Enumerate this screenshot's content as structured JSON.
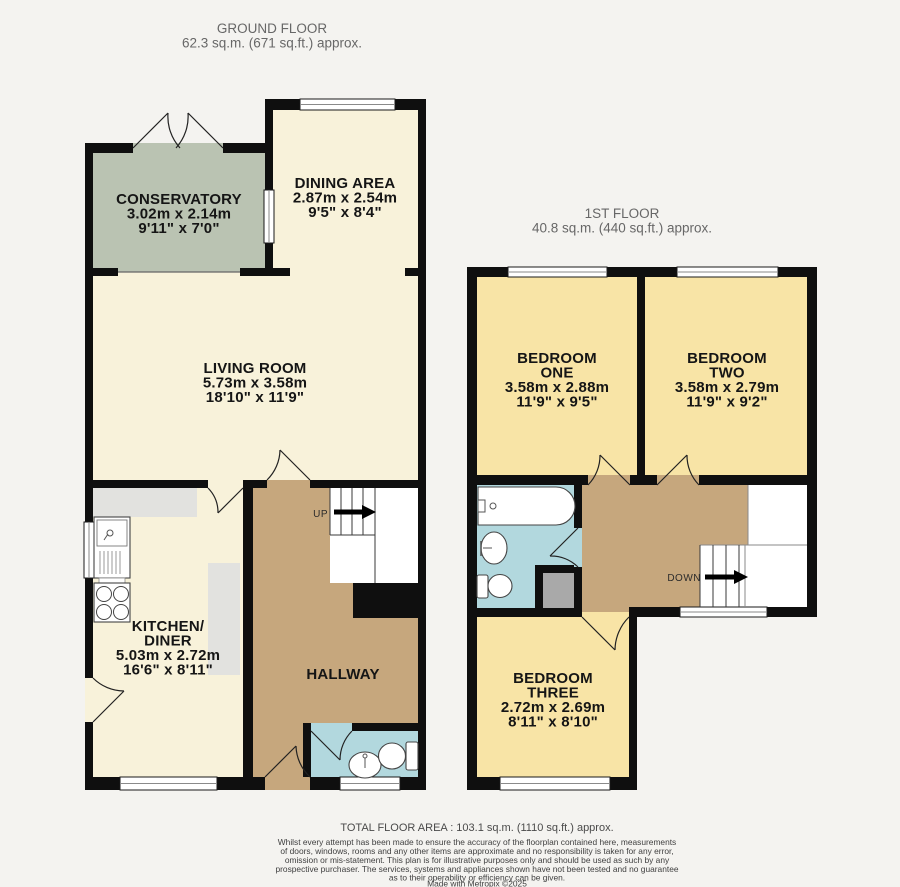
{
  "floors": {
    "ground": {
      "title": "GROUND FLOOR",
      "area": "62.3 sq.m. (671 sq.ft.) approx."
    },
    "first": {
      "title": "1ST FLOOR",
      "area": "40.8 sq.m. (440 sq.ft.) approx."
    }
  },
  "rooms": {
    "conservatory": {
      "name": "CONSERVATORY",
      "metric": "3.02m x 2.14m",
      "imperial": "9'11\" x 7'0\""
    },
    "dining": {
      "name": "DINING AREA",
      "metric": "2.87m x 2.54m",
      "imperial": "9'5\" x 8'4\""
    },
    "living": {
      "name": "LIVING ROOM",
      "metric": "5.73m x 3.58m",
      "imperial": "18'10\" x 11'9\""
    },
    "kitchen": {
      "name_line1": "KITCHEN/",
      "name_line2": "DINER",
      "metric": "5.03m x 2.72m",
      "imperial": "16'6\" x 8'11\""
    },
    "hallway": {
      "name": "HALLWAY"
    },
    "bedroom1": {
      "name_line1": "BEDROOM",
      "name_line2": "ONE",
      "metric": "3.58m x 2.88m",
      "imperial": "11'9\" x 9'5\""
    },
    "bedroom2": {
      "name_line1": "BEDROOM",
      "name_line2": "TWO",
      "metric": "3.58m x 2.79m",
      "imperial": "11'9\" x 9'2\""
    },
    "bedroom3": {
      "name_line1": "BEDROOM",
      "name_line2": "THREE",
      "metric": "2.72m x 2.69m",
      "imperial": "8'11\" x 8'10\""
    }
  },
  "stairs": {
    "up": "UP",
    "down": "DOWN"
  },
  "footer": {
    "total": "TOTAL FLOOR AREA : 103.1 sq.m. (1110 sq.ft.) approx.",
    "disclaimer": [
      "Whilst every attempt has been made to ensure the accuracy of the floorplan contained here, measurements",
      "of doors, windows, rooms and any other items are approximate and no responsibility is taken for any error,",
      "omission or mis-statement. This plan is for illustrative purposes only and should be used as such by any",
      "prospective purchaser. The services, systems and appliances shown have not been tested and no guarantee",
      "as to their operability or efficiency can be given.",
      "Made with Metropix ©2025"
    ]
  },
  "colors": {
    "background": "#f4f3f0",
    "wall": "#0f0f0f",
    "cream": "#f8f2da",
    "bedroom": "#f8e4a6",
    "conservatory": "#bac3b2",
    "hallway": "#c6a77d",
    "bathroom": "#b2d8de",
    "counter": "#e2e2df",
    "cupboard": "#a9a9a9",
    "stairs_white": "#ffffff"
  }
}
